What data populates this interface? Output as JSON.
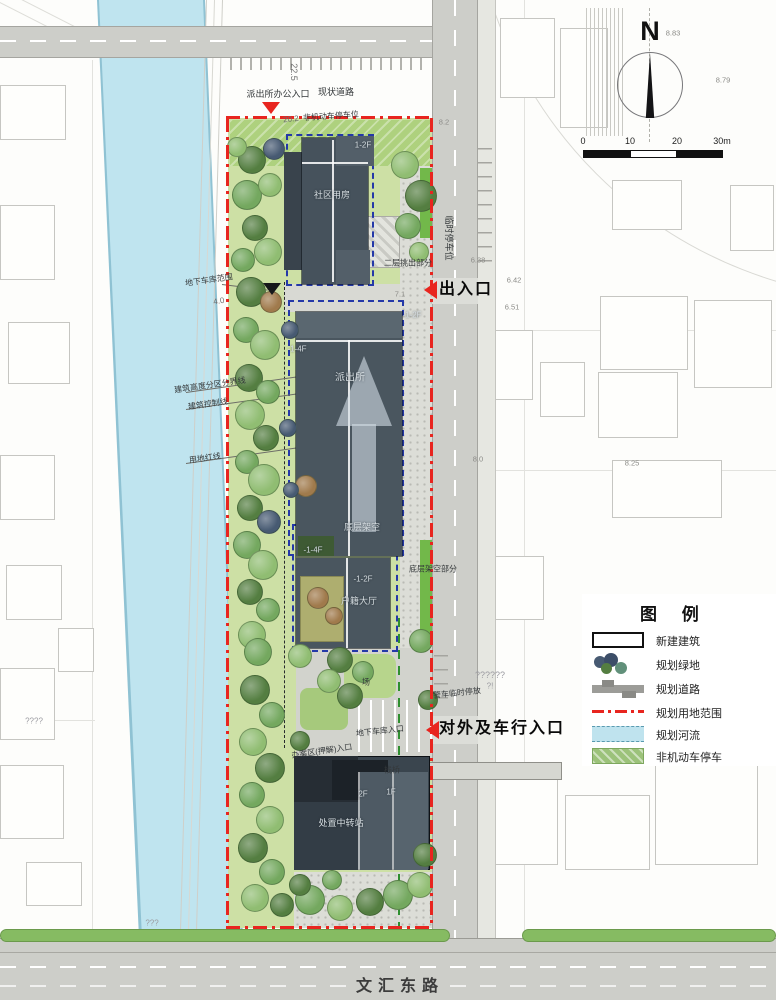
{
  "compass": {
    "label": "N"
  },
  "scalebar": {
    "ticks": [
      "0",
      "10",
      "20",
      "30m"
    ]
  },
  "legend": {
    "title": "图 例",
    "items": [
      {
        "key": "new-building",
        "label": "新建建筑"
      },
      {
        "key": "planned-green",
        "label": "规划绿地"
      },
      {
        "key": "planned-road",
        "label": "规划道路"
      },
      {
        "key": "site-boundary",
        "label": "规划用地范围"
      },
      {
        "key": "planned-river",
        "label": "规划河流"
      },
      {
        "key": "non-motor-parking",
        "label": "非机动车停车"
      }
    ]
  },
  "colors": {
    "boundary_red": "#e8251f",
    "river_blue": "#bfe4ef",
    "green_space": "#cde0a5",
    "building_gray": "#4a565f",
    "road_gray": "#cdcec9"
  },
  "annotations": [
    {
      "t": "派出所办公入口",
      "x": 278,
      "y": 95,
      "r": 0,
      "c": "std",
      "s": 9
    },
    {
      "t": "现状道路",
      "x": 336,
      "y": 93,
      "r": 0,
      "c": "std",
      "s": 9
    },
    {
      "t": "22.5",
      "x": 293,
      "y": 72,
      "r": 90,
      "c": "dim",
      "s": 9
    },
    {
      "t": "20.2",
      "x": 291,
      "y": 120,
      "r": -6,
      "c": "dim",
      "s": 8
    },
    {
      "t": "非机动车停车位",
      "x": 331,
      "y": 117,
      "r": -4,
      "c": "std",
      "s": 8
    },
    {
      "t": "1-2F",
      "x": 363,
      "y": 146,
      "r": 0,
      "c": "onbld",
      "s": 8
    },
    {
      "t": "社区用房",
      "x": 332,
      "y": 196,
      "r": 0,
      "c": "onbld",
      "s": 9
    },
    {
      "t": "临时停车位",
      "x": 448,
      "y": 238,
      "r": 90,
      "c": "std",
      "s": 9
    },
    {
      "t": "地下车库范围",
      "x": 209,
      "y": 281,
      "r": -8,
      "c": "std",
      "s": 8
    },
    {
      "t": "4.0",
      "x": 219,
      "y": 302,
      "r": -10,
      "c": "dim",
      "s": 8
    },
    {
      "t": "二层挑出部分",
      "x": 408,
      "y": 264,
      "r": 0,
      "c": "std",
      "s": 8
    },
    {
      "t": "出入口",
      "x": 466,
      "y": 290,
      "r": 0,
      "c": "big",
      "s": 16
    },
    {
      "t": "-1-2F",
      "x": 412,
      "y": 316,
      "r": 0,
      "c": "onbld",
      "s": 8
    },
    {
      "t": "派出所",
      "x": 350,
      "y": 378,
      "r": 0,
      "c": "onbld",
      "s": 10
    },
    {
      "t": "建筑高度分区分界线",
      "x": 210,
      "y": 386,
      "r": -8,
      "c": "std",
      "s": 8
    },
    {
      "t": "建筑控制线",
      "x": 208,
      "y": 405,
      "r": -8,
      "c": "std",
      "s": 8
    },
    {
      "t": "用地红线",
      "x": 205,
      "y": 459,
      "r": -8,
      "c": "std",
      "s": 8
    },
    {
      "t": "-1-4F",
      "x": 297,
      "y": 350,
      "r": 0,
      "c": "onbld",
      "s": 8
    },
    {
      "t": "底层架空",
      "x": 362,
      "y": 528,
      "r": 0,
      "c": "onbld",
      "s": 9
    },
    {
      "t": "-1-4F",
      "x": 313,
      "y": 551,
      "r": 0,
      "c": "onbld",
      "s": 8
    },
    {
      "t": "-1-2F",
      "x": 363,
      "y": 580,
      "r": 0,
      "c": "onbld",
      "s": 8
    },
    {
      "t": "户籍大厅",
      "x": 359,
      "y": 602,
      "r": 0,
      "c": "onbld",
      "s": 9
    },
    {
      "t": "底层架空部分",
      "x": 433,
      "y": 570,
      "r": 0,
      "c": "std",
      "s": 8
    },
    {
      "t": "警车临时停放",
      "x": 457,
      "y": 694,
      "r": -6,
      "c": "std",
      "s": 8
    },
    {
      "t": "??????",
      "x": 490,
      "y": 676,
      "r": 0,
      "c": "faint",
      "s": 9
    },
    {
      "t": "?!",
      "x": 490,
      "y": 687,
      "r": 0,
      "c": "faint",
      "s": 8
    },
    {
      "t": "对外及车行入口",
      "x": 502,
      "y": 729,
      "r": 0,
      "c": "big",
      "s": 16
    },
    {
      "t": "地下车库入口",
      "x": 380,
      "y": 732,
      "r": -6,
      "c": "std",
      "s": 8
    },
    {
      "t": "场",
      "x": 366,
      "y": 683,
      "r": 0,
      "c": "std",
      "s": 8
    },
    {
      "t": "办案区(押解)入口",
      "x": 322,
      "y": 752,
      "r": -8,
      "c": "std",
      "s": 8
    },
    {
      "t": "栈桥",
      "x": 392,
      "y": 771,
      "r": 0,
      "c": "std",
      "s": 8
    },
    {
      "t": "2F",
      "x": 363,
      "y": 795,
      "r": 0,
      "c": "onbld",
      "s": 8
    },
    {
      "t": "1F",
      "x": 391,
      "y": 793,
      "r": 0,
      "c": "onbld",
      "s": 8
    },
    {
      "t": "处置中转站",
      "x": 341,
      "y": 824,
      "r": 0,
      "c": "onbld",
      "s": 9
    },
    {
      "t": "文汇东路",
      "x": 400,
      "y": 987,
      "r": 0,
      "c": "road",
      "s": 16
    },
    {
      "t": "????",
      "x": 34,
      "y": 722,
      "r": 0,
      "c": "faint",
      "s": 8
    },
    {
      "t": "???",
      "x": 152,
      "y": 924,
      "r": 0,
      "c": "faint",
      "s": 8
    }
  ],
  "spot_elevations": [
    {
      "v": "8.83",
      "x": 673,
      "y": 33
    },
    {
      "v": "8.79",
      "x": 723,
      "y": 80
    },
    {
      "v": "6.38",
      "x": 478,
      "y": 260
    },
    {
      "v": "6.42",
      "x": 514,
      "y": 280
    },
    {
      "v": "6.51",
      "x": 512,
      "y": 307
    },
    {
      "v": "7.1",
      "x": 400,
      "y": 294
    },
    {
      "v": "8.0",
      "x": 478,
      "y": 459
    },
    {
      "v": "8.25",
      "x": 632,
      "y": 463
    },
    {
      "v": "7.6",
      "x": 716,
      "y": 622
    },
    {
      "v": "8.2",
      "x": 444,
      "y": 122
    }
  ],
  "markers": [
    {
      "t": "down",
      "c": "#e8251f",
      "x": 271,
      "y": 108
    },
    {
      "t": "down",
      "c": "#16181a",
      "x": 272,
      "y": 289
    },
    {
      "t": "left",
      "c": "#e8251f",
      "x": 430,
      "y": 290
    },
    {
      "t": "left",
      "c": "#e8251f",
      "x": 432,
      "y": 730
    }
  ],
  "tree_palette": [
    "#74a85f",
    "#547e41",
    "#90bd72",
    "#abcf8d",
    "#61907a",
    "#a07a4c",
    "#475a72"
  ],
  "trees": [
    [
      252,
      160,
      14,
      1
    ],
    [
      274,
      149,
      11,
      6
    ],
    [
      237,
      147,
      10,
      2
    ],
    [
      247,
      195,
      15,
      0
    ],
    [
      270,
      185,
      12,
      2
    ],
    [
      255,
      228,
      13,
      1
    ],
    [
      243,
      260,
      12,
      0
    ],
    [
      268,
      252,
      14,
      2
    ],
    [
      251,
      292,
      15,
      1
    ],
    [
      271,
      302,
      11,
      5
    ],
    [
      246,
      330,
      13,
      0
    ],
    [
      265,
      345,
      15,
      2
    ],
    [
      249,
      378,
      14,
      1
    ],
    [
      268,
      392,
      12,
      0
    ],
    [
      250,
      415,
      15,
      2
    ],
    [
      266,
      438,
      13,
      1
    ],
    [
      247,
      462,
      12,
      0
    ],
    [
      264,
      480,
      16,
      2
    ],
    [
      250,
      508,
      13,
      1
    ],
    [
      269,
      522,
      12,
      6
    ],
    [
      247,
      545,
      14,
      0
    ],
    [
      263,
      565,
      15,
      2
    ],
    [
      250,
      592,
      13,
      1
    ],
    [
      268,
      610,
      12,
      0
    ],
    [
      252,
      635,
      14,
      2
    ],
    [
      405,
      165,
      14,
      2
    ],
    [
      421,
      196,
      16,
      1
    ],
    [
      408,
      226,
      13,
      0
    ],
    [
      419,
      252,
      10,
      2
    ],
    [
      290,
      330,
      9,
      6
    ],
    [
      288,
      428,
      9,
      6
    ],
    [
      306,
      486,
      11,
      5
    ],
    [
      291,
      490,
      8,
      6
    ],
    [
      318,
      598,
      11,
      5
    ],
    [
      334,
      616,
      9,
      5
    ],
    [
      258,
      652,
      14,
      0
    ],
    [
      300,
      656,
      12,
      2
    ],
    [
      340,
      660,
      13,
      1
    ],
    [
      363,
      672,
      11,
      0
    ],
    [
      329,
      681,
      12,
      2
    ],
    [
      350,
      696,
      13,
      1
    ],
    [
      255,
      690,
      15,
      1
    ],
    [
      272,
      715,
      13,
      0
    ],
    [
      253,
      742,
      14,
      2
    ],
    [
      300,
      741,
      10,
      1
    ],
    [
      270,
      768,
      15,
      1
    ],
    [
      252,
      795,
      13,
      0
    ],
    [
      270,
      820,
      14,
      2
    ],
    [
      253,
      848,
      15,
      1
    ],
    [
      272,
      872,
      13,
      0
    ],
    [
      255,
      898,
      14,
      2
    ],
    [
      282,
      905,
      12,
      1
    ],
    [
      310,
      900,
      15,
      0
    ],
    [
      340,
      908,
      13,
      2
    ],
    [
      370,
      902,
      14,
      1
    ],
    [
      398,
      895,
      15,
      0
    ],
    [
      420,
      885,
      13,
      2
    ],
    [
      425,
      855,
      12,
      1
    ],
    [
      300,
      885,
      11,
      1
    ],
    [
      332,
      880,
      10,
      0
    ],
    [
      421,
      641,
      12,
      0
    ],
    [
      428,
      700,
      10,
      1
    ]
  ],
  "context_buildings": [
    [
      500,
      18,
      55,
      80
    ],
    [
      560,
      28,
      48,
      100
    ],
    [
      612,
      180,
      70,
      50
    ],
    [
      730,
      185,
      44,
      66
    ],
    [
      478,
      330,
      55,
      70
    ],
    [
      540,
      362,
      45,
      55
    ],
    [
      600,
      296,
      88,
      74
    ],
    [
      694,
      300,
      78,
      88
    ],
    [
      598,
      372,
      80,
      66
    ],
    [
      612,
      460,
      110,
      58
    ],
    [
      480,
      556,
      64,
      64
    ],
    [
      480,
      770,
      78,
      95
    ],
    [
      565,
      795,
      85,
      75
    ],
    [
      655,
      762,
      103,
      103
    ],
    [
      0,
      85,
      66,
      55
    ],
    [
      0,
      205,
      55,
      75
    ],
    [
      8,
      322,
      62,
      62
    ],
    [
      0,
      455,
      55,
      65
    ],
    [
      6,
      565,
      56,
      55
    ],
    [
      0,
      668,
      55,
      72
    ],
    [
      58,
      628,
      36,
      44
    ],
    [
      0,
      765,
      64,
      74
    ],
    [
      26,
      862,
      56,
      44
    ]
  ]
}
